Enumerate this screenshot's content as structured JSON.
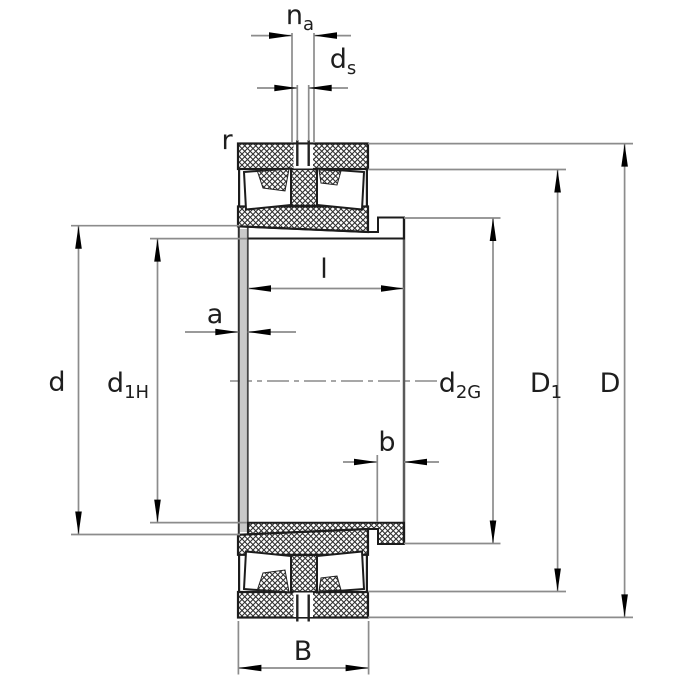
{
  "drawing": {
    "labels": {
      "na": {
        "main": "n",
        "sub": "a"
      },
      "ds": {
        "main": "d",
        "sub": "s"
      },
      "r": {
        "main": "r"
      },
      "l": {
        "main": "l"
      },
      "a": {
        "main": "a"
      },
      "d": {
        "main": "d"
      },
      "d1H": {
        "main": "d",
        "sub": "1H"
      },
      "d2G": {
        "main": "d",
        "sub": "2G"
      },
      "D1": {
        "main": "D",
        "sub": "1"
      },
      "D": {
        "main": "D"
      },
      "b": {
        "main": "b"
      },
      "B": {
        "main": "B"
      }
    },
    "colors": {
      "contour": "#1c1c1c",
      "dimension_line": "#8c8c8c",
      "hatch": "#2f2f2f",
      "arrow": "#000000",
      "background": "#ffffff"
    }
  }
}
